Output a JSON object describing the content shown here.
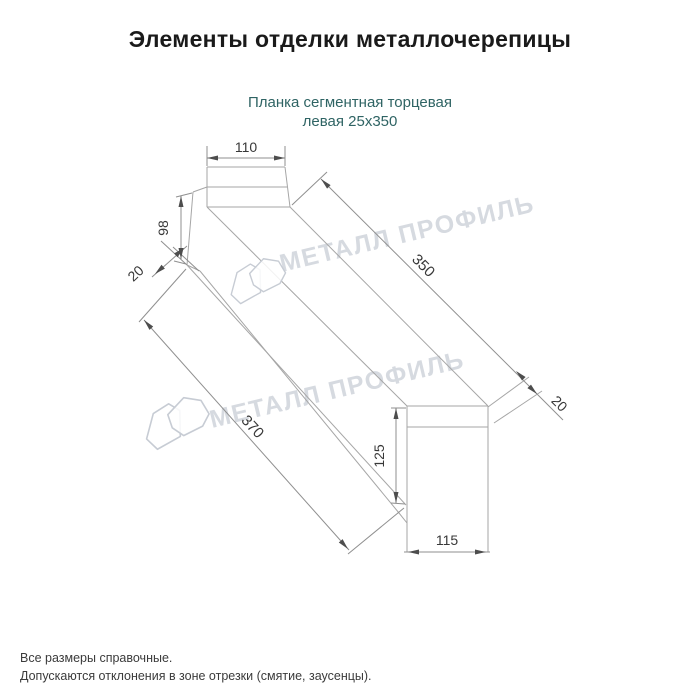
{
  "header": {
    "title": "Элементы отделки металлочерепицы"
  },
  "product": {
    "subtitle_line1": "Планка сегментная торцевая",
    "subtitle_line2": "левая 25х350",
    "accent_color": "#2f6464"
  },
  "drawing": {
    "dimensions": {
      "top_width": "110",
      "left_height": "98",
      "left_fold": "20",
      "length_top": "350",
      "right_fold": "20",
      "length_bottom": "370",
      "end_height": "125",
      "end_width": "115"
    },
    "line_color": "#a6a6a6",
    "dim_text_color": "#383838"
  },
  "watermark": {
    "text": "МЕТАЛЛ ПРОФИЛЬ",
    "logo": "metall-profil-cloud-logo",
    "color": "#ccd1d9"
  },
  "footer": {
    "note1": "Все размеры справочные.",
    "note2": "Допускаются отклонения в зоне отрезки (смятие, заусенцы)."
  }
}
